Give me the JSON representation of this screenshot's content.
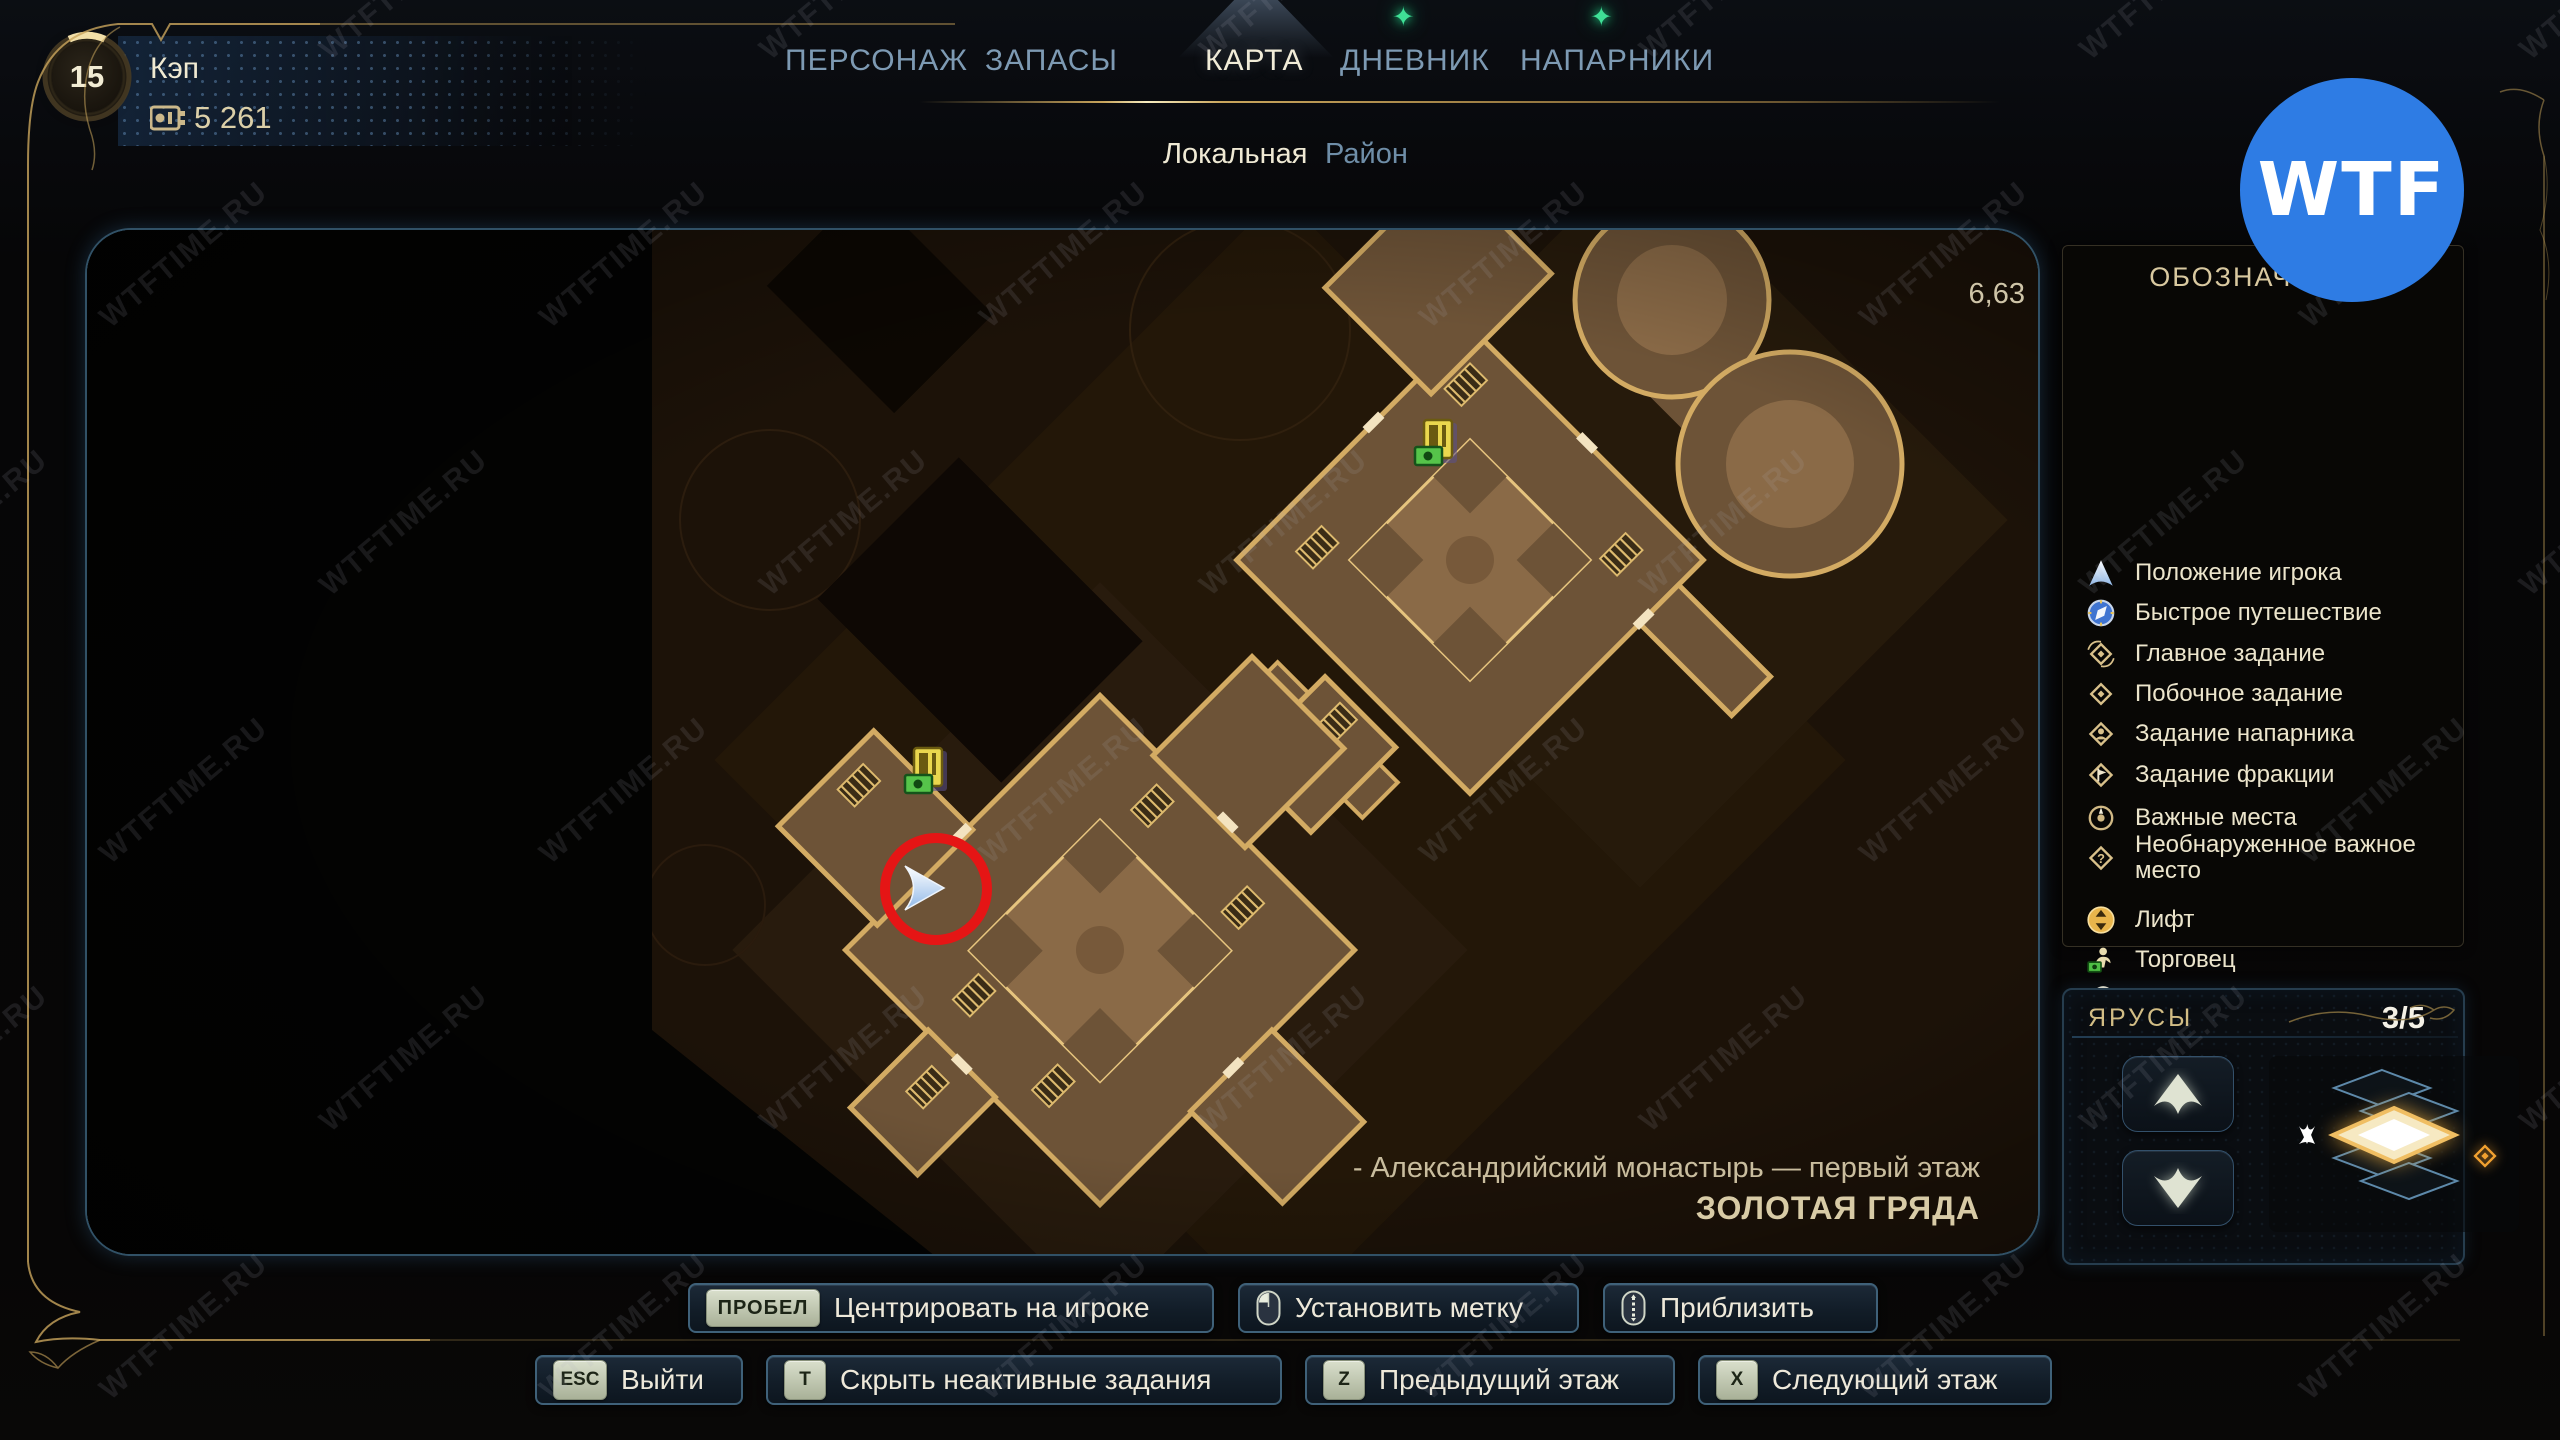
{
  "player": {
    "level": "15",
    "name": "Кэп",
    "currency": "5 261"
  },
  "tabs": [
    {
      "label": "ПЕРСОНАЖ",
      "active": false,
      "notification": false
    },
    {
      "label": "ЗАПАСЫ",
      "active": false,
      "notification": false
    },
    {
      "label": "КАРТА",
      "active": true,
      "notification": false
    },
    {
      "label": "ДНЕВНИК",
      "active": false,
      "notification": true
    },
    {
      "label": "НАПАРНИКИ",
      "active": false,
      "notification": true
    }
  ],
  "subtabs": [
    {
      "label": "Локальная",
      "active": true
    },
    {
      "label": "Район",
      "active": false
    }
  ],
  "map": {
    "coordinates": "6,63",
    "location_line1": "- Александрийский монастырь — первый этаж",
    "location_line2": "ЗОЛОТАЯ ГРЯДА"
  },
  "legend": {
    "title": "ОБОЗНАЧЕНИЯ",
    "items": [
      {
        "icon": "player-position-icon",
        "label": "Положение игрока"
      },
      {
        "icon": "fast-travel-icon",
        "label": "Быстрое путешествие"
      },
      {
        "icon": "main-quest-icon",
        "label": "Главное задание"
      },
      {
        "icon": "side-quest-icon",
        "label": "Побочное задание"
      },
      {
        "icon": "companion-quest-icon",
        "label": "Задание напарника"
      },
      {
        "icon": "faction-quest-icon",
        "label": "Задание фракции"
      },
      {
        "icon": "important-place-icon",
        "label": "Важные места"
      },
      {
        "icon": "undiscovered-place-icon",
        "label": "Необнаруженное важное место"
      },
      {
        "icon": "elevator-icon",
        "label": "Лифт"
      },
      {
        "icon": "merchant-icon",
        "label": "Торговец"
      },
      {
        "icon": "doctor-icon",
        "label": "Доктор"
      },
      {
        "icon": "autodoc-icon",
        "label": "Автодок"
      },
      {
        "icon": "vending-machine-icon",
        "label": "Торговый автомат"
      },
      {
        "icon": "workbench-icon",
        "label": "Верстак"
      }
    ]
  },
  "floors": {
    "title": "ЯРУСЫ",
    "counter": "3/5"
  },
  "hints_row1": [
    {
      "key": "ПРОБЕЛ",
      "key_type": "text",
      "label": "Центрировать на игроке"
    },
    {
      "key": "mouse-left",
      "key_type": "mouse-left",
      "label": "Установить метку"
    },
    {
      "key": "mouse-wheel",
      "key_type": "mouse-wheel",
      "label": "Приблизить"
    }
  ],
  "hints_row2": [
    {
      "key": "ESC",
      "label": "Выйти"
    },
    {
      "key": "T",
      "label": "Скрыть неактивные задания"
    },
    {
      "key": "Z",
      "label": "Предыдущий этаж"
    },
    {
      "key": "X",
      "label": "Следующий этаж"
    }
  ],
  "watermark": {
    "text": "WTFTIME.RU",
    "logo": "WTF"
  },
  "colors": {
    "tab_active": "#f1ecd8",
    "tab_inactive": "#7d9ab3",
    "gold": "#d3ab63",
    "notification_green": "#3fe096",
    "annotation_red": "#e51515",
    "logo_blue": "#2e7ce4",
    "map_wall": "#d3ab63",
    "map_room": "#6d5337",
    "map_courtyard": "#8a6a47"
  }
}
